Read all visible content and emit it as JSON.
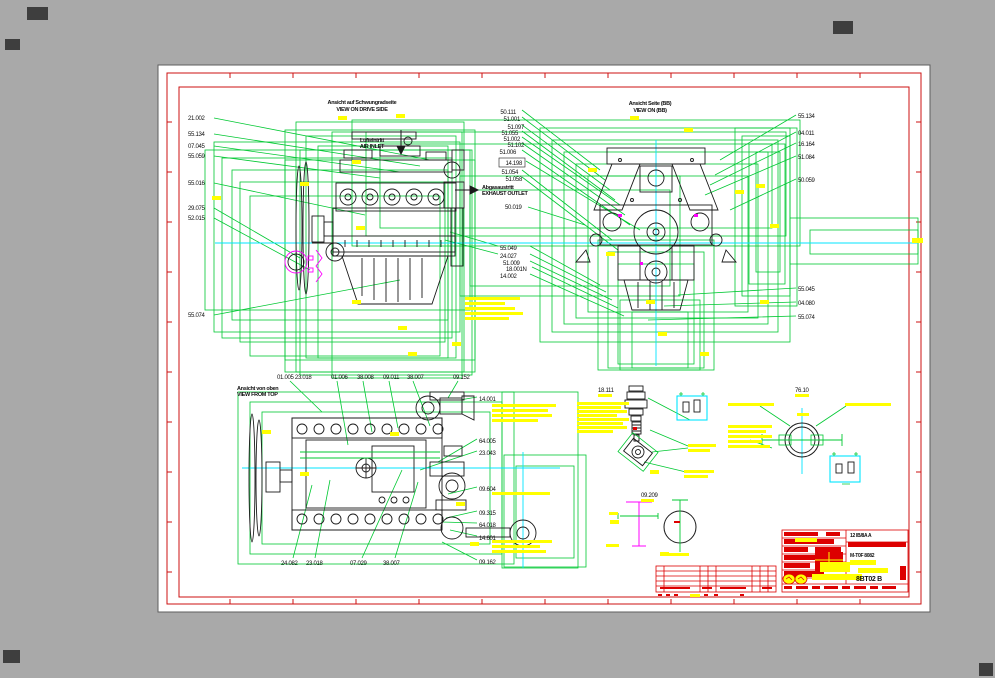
{
  "window": {
    "background": "#a9a9a9",
    "sheet_background": "#ffffff"
  },
  "colors": {
    "cad_green": "#00c832",
    "cad_cyan": "#00e5ff",
    "cad_yellow": "#ffff00",
    "cad_red": "#dd0000",
    "cad_magenta": "#ff00ff",
    "linework": "#1a1a1a"
  },
  "views": {
    "flywheel_side": {
      "title_de": "Ansicht auf Schwungradseite",
      "title_en": "VIEW ON DRIVE SIDE",
      "labels_left": [
        "21.002",
        "55.134",
        "07.045",
        "55.059",
        "55.016",
        "29.075",
        "52.015",
        "55.074"
      ],
      "labels_mid": [
        "50.111",
        "51.001",
        "51.097",
        "51.055",
        "51.002",
        "51.102",
        "51.006",
        "14.198",
        "51.054",
        "51.058"
      ],
      "air_inlet_de": "Lufteintritt",
      "air_inlet_en": "AIR INLET",
      "exhaust_de": "Abgasaustritt",
      "exhaust_en": "EXHAUST OUTLET",
      "label_right": "50.019",
      "labels_center": [
        "55.049",
        "24.027",
        "51.009",
        "18.001N",
        "14.002"
      ]
    },
    "front_view": {
      "title_de": "Ansicht Seite (BB)",
      "title_en": "VIEW ON (BB)",
      "labels_right": [
        "55.134",
        "04.011",
        "16.164",
        "51.084",
        "50.059"
      ],
      "labels_lower_right": [
        "55.045",
        "04.080",
        "55.074"
      ]
    },
    "top_view": {
      "title_de": "Ansicht von oben",
      "title_en": "VIEW FROM TOP",
      "labels_top": [
        "01.005 23.018",
        "01.006",
        "38.008",
        "09.011",
        "38.007",
        "09.152"
      ],
      "labels_right": [
        "14.001",
        "64.005",
        "23.043",
        "09.604",
        "09.315",
        "64.018",
        "14.601",
        "09.162"
      ],
      "labels_bottom": [
        "24.082",
        "23.018",
        "07.029",
        "38.007"
      ]
    },
    "details": {
      "sensor_label": "18.111",
      "flange_label": "76.10",
      "bracket_label": "09.209"
    }
  },
  "title_block": {
    "revision_cell": "12  IB/8A A",
    "type_text": "M-T0F 8082",
    "drawing_number": "8BT02 B"
  }
}
